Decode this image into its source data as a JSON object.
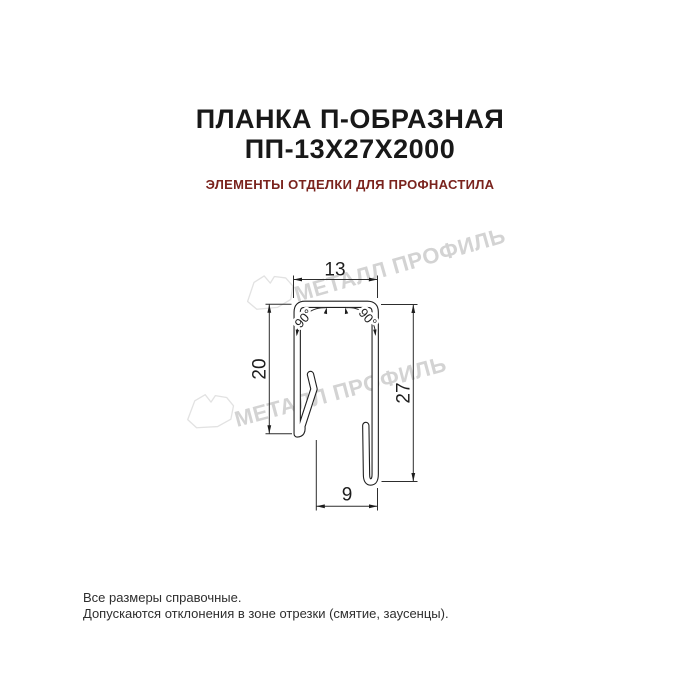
{
  "header": {
    "title_line1": "ПЛАНКА П-ОБРАЗНАЯ",
    "title_line2": "ПП-13Х27Х2000",
    "subtitle": "ЭЛЕМЕНТЫ ОТДЕЛКИ ДЛЯ ПРОФНАСТИЛА"
  },
  "drawing": {
    "dim_top_width": "13",
    "dim_left_height": "20",
    "dim_right_height": "27",
    "dim_bottom_width": "9",
    "angle_left": "90°",
    "angle_right": "90°"
  },
  "watermark": {
    "text": "МЕТАЛЛ ПРОФИЛЬ",
    "logo": "metall-profil-crystal"
  },
  "footer": {
    "line1": "Все размеры справочные.",
    "line2": "Допускаются отклонения в зоне отрезки (смятие, заусенцы)."
  },
  "colors": {
    "background": "#ffffff",
    "title": "#181818",
    "subtitle_red": "#7a231d",
    "drawing_lines": "#1f1f1f",
    "watermark_gray": "#d3d3d3"
  }
}
